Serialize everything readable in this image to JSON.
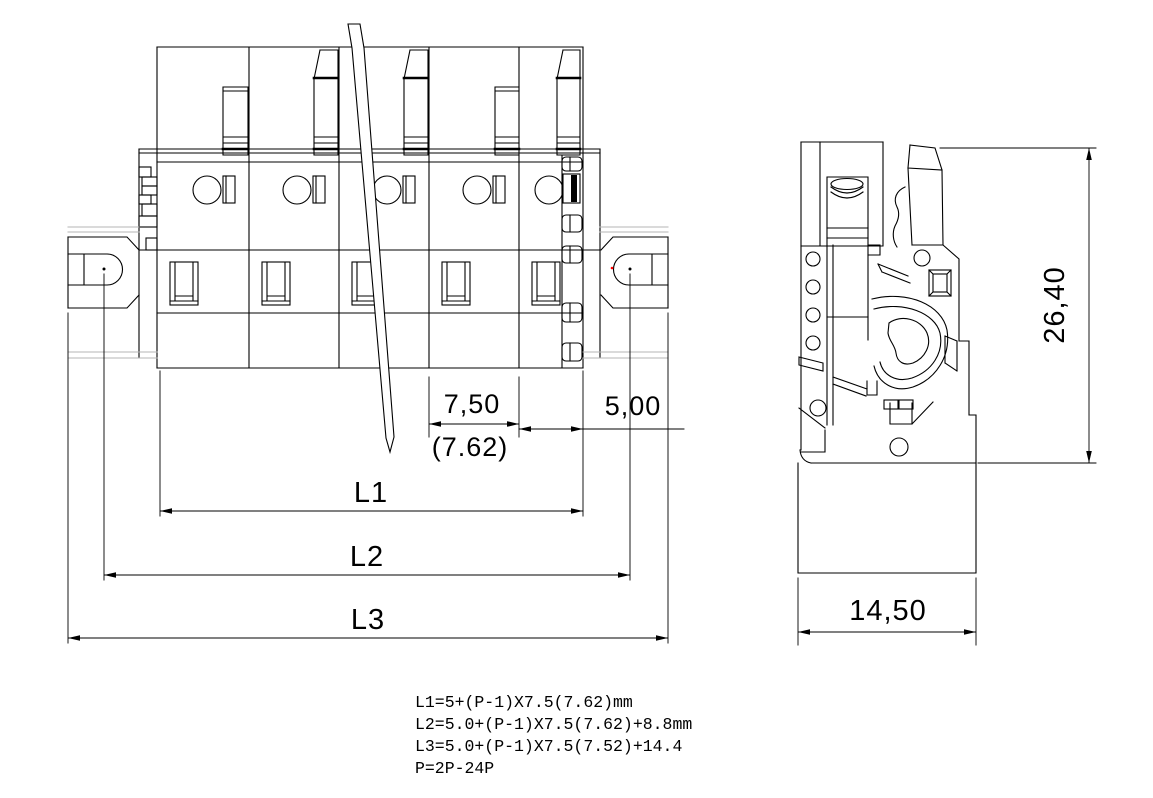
{
  "drawing": {
    "type": "technical-dimension-drawing",
    "subject": "pluggable terminal block connector",
    "views": {
      "front": {
        "name": "front-view",
        "poles_shown": 5
      },
      "side": {
        "name": "side-view"
      }
    }
  },
  "dimensions": {
    "pitch": "7,50",
    "pitch_alt": "(7.62)",
    "end_width": "5,00",
    "l1_label": "L1",
    "l2_label": "L2",
    "l3_label": "L3",
    "side_height": "26,40",
    "side_width": "14,50"
  },
  "notes": [
    "L1=5+(P-1)X7.5(7.62)mm",
    "L2=5.0+(P-1)X7.5(7.62)+8.8mm",
    "L3=5.0+(P-1)X7.5(7.52)+14.4",
    "P=2P-24P"
  ],
  "colors": {
    "line": "#000000",
    "hidden_line": "#b4b4b4",
    "background": "#ffffff",
    "artifact_dot": "#ff0000"
  }
}
